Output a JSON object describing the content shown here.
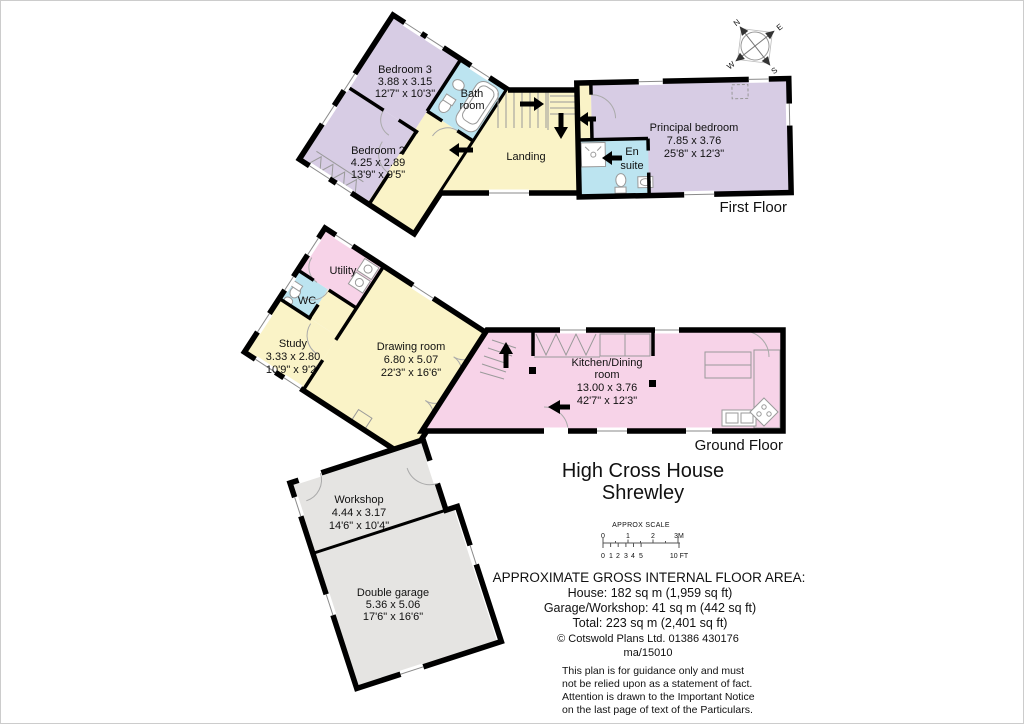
{
  "colors": {
    "bedroom": "#d7cce4",
    "bath": "#bce4f0",
    "living": "#faf3c7",
    "kitchen": "#f7d3e8",
    "garage": "#e5e4e2",
    "wall": "#000000"
  },
  "compass": {
    "n": "N",
    "e": "E",
    "s": "S",
    "w": "W"
  },
  "first_floor": {
    "label": "First Floor",
    "bedroom3": {
      "name": "Bedroom 3",
      "metric": "3.88 x 3.15",
      "imperial": "12'7\" x 10'3\""
    },
    "bedroom2": {
      "name": "Bedroom 2",
      "metric": "4.25 x 2.89",
      "imperial": "13'9\" x 9'5\""
    },
    "bathroom": {
      "line1": "Bath",
      "line2": "room"
    },
    "landing": {
      "name": "Landing"
    },
    "ensuite": {
      "line1": "En",
      "line2": "suite"
    },
    "principal": {
      "name": "Principal bedroom",
      "metric": "7.85 x 3.76",
      "imperial": "25'8\" x 12'3\""
    }
  },
  "ground_floor": {
    "label": "Ground Floor",
    "utility": {
      "name": "Utility"
    },
    "wc": {
      "name": "WC"
    },
    "study": {
      "name": "Study",
      "metric": "3.33 x 2.80",
      "imperial": "10'9\" x 9'2\""
    },
    "drawing": {
      "name": "Drawing room",
      "metric": "6.80 x 5.07",
      "imperial": "22'3\" x 16'6\""
    },
    "kitchen": {
      "line1": "Kitchen/Dining",
      "line2": "room",
      "metric": "13.00 x 3.76",
      "imperial": "42'7\" x 12'3\""
    }
  },
  "outbuilding": {
    "workshop": {
      "name": "Workshop",
      "metric": "4.44 x 3.17",
      "imperial": "14'6\" x 10'4\""
    },
    "garage": {
      "name": "Double garage",
      "metric": "5.36 x 5.06",
      "imperial": "17'6\" x 16'6\""
    }
  },
  "title": {
    "line1": "High Cross House",
    "line2": "Shrewley"
  },
  "scale_bar": {
    "heading": "APPROX SCALE",
    "m_labels": [
      "0",
      "1",
      "2",
      "3M"
    ],
    "ft_labels": [
      "0",
      "1",
      "2",
      "3",
      "4",
      "5",
      "10 FT"
    ]
  },
  "areas": {
    "heading": "APPROXIMATE GROSS INTERNAL FLOOR AREA:",
    "house": "House: 182 sq m (1,959 sq ft)",
    "garage_workshop": "Garage/Workshop: 41 sq m (442 sq ft)",
    "total": "Total: 223 sq m (2,401 sq ft)",
    "copyright": "©  Cotswold Plans Ltd. 01386 430176",
    "ref": "ma/15010",
    "disclaimer1": "This plan is for guidance only and must",
    "disclaimer2": "not be relied upon as a statement of fact.",
    "disclaimer3": "Attention is drawn to the Important Notice",
    "disclaimer4": "on the last page of text of the Particulars."
  }
}
